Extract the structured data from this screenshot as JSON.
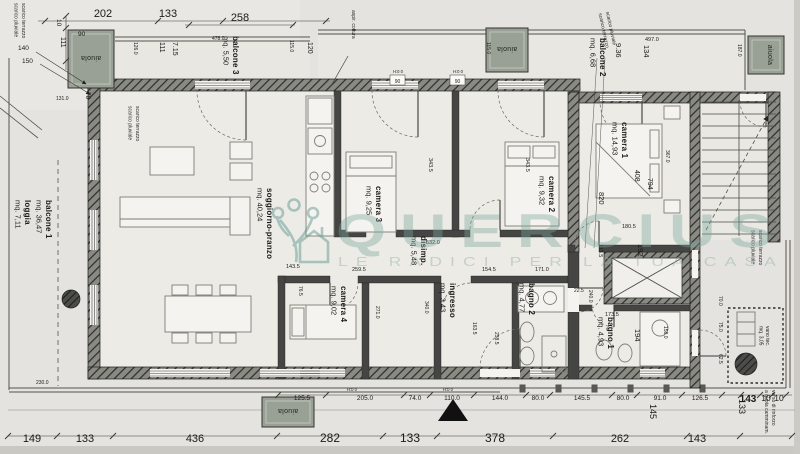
{
  "watermark": {
    "brand": "QUERCIUS",
    "tagline": "LE RADICI PER LA TUA CASA"
  },
  "rooms": {
    "soggiorno": {
      "name": "soggiorno-pranzo",
      "area": "mq. 40,24"
    },
    "camera1": {
      "name": "camera 1",
      "area": "mq. 14,93"
    },
    "camera2": {
      "name": "camera 2",
      "area": "mq. 9,32"
    },
    "camera3": {
      "name": "camera 3",
      "area": "mq. 9,25"
    },
    "camera4": {
      "name": "camera 4",
      "area": "mq. 9,02"
    },
    "disimpegno": {
      "name": "disimp.",
      "area": "mq. 5,48"
    },
    "ingresso": {
      "name": "ingresso",
      "area": "mq. 3,43"
    },
    "bagno1": {
      "name": "bagno 1",
      "area": "mq. 4,93"
    },
    "bagno2": {
      "name": "bagno 2",
      "area": "mq. 4,77"
    },
    "vano_tec": {
      "name": "vano tec.",
      "area": "mq. 3,05"
    }
  },
  "outdoor": {
    "loggia": {
      "name": "loggia",
      "area": "mq. 7,11"
    },
    "balcone1": {
      "name": "balcone 1",
      "area": "mq. 36,47"
    },
    "balcone2": {
      "name": "balcone 2",
      "area": "mq. 6,68"
    },
    "balcone3": {
      "name": "balcone 3",
      "area": "mq. 5,50"
    },
    "aiuola": "aiuola"
  },
  "annotations": {
    "scarico_terrazzo": "scarico terrazzo",
    "scarico_pluviale": "scarico pluviale",
    "aspirazione": "aspir. cottura",
    "nota_quota_1": "verso di rinforzo",
    "nota_quota_2": "a quota camminam.",
    "marker_h": "H:0 0",
    "marker_90": "90"
  },
  "dims": {
    "top": [
      "202",
      "133",
      "258"
    ],
    "left": [
      "10",
      "111",
      "90",
      "140",
      "150",
      "70",
      "131.0",
      "230.0"
    ],
    "balcone3": [
      "478.0",
      "126.0",
      "111",
      "7.15",
      "115.0",
      "120"
    ],
    "balcone2": [
      "115.0",
      "497.0",
      "9.36",
      "134",
      "187.0"
    ],
    "camera1": [
      "820",
      "408",
      "794",
      "367.0",
      "180.5",
      "113.5",
      "192"
    ],
    "bagno1": [
      "173.5",
      "194",
      "158.0",
      "240.0",
      "22.5"
    ],
    "interior": [
      "343.5",
      "343.5",
      "532.0",
      "271.0",
      "340.0",
      "76.5",
      "238.5",
      "163.5",
      "259.5",
      "154.5",
      "171.0",
      "143.5"
    ],
    "right_edge": [
      "70.0",
      "75.0",
      "62.5",
      "145",
      "133"
    ],
    "row2": [
      "125.5",
      "205.0",
      "74.0",
      "110.0",
      "144.0",
      "80.0",
      "145.5",
      "80.0",
      "91.0",
      "126.5",
      "143",
      "10",
      "10"
    ],
    "bottom": [
      "149",
      "133",
      "436",
      "282",
      "133",
      "378",
      "262",
      "143"
    ]
  }
}
